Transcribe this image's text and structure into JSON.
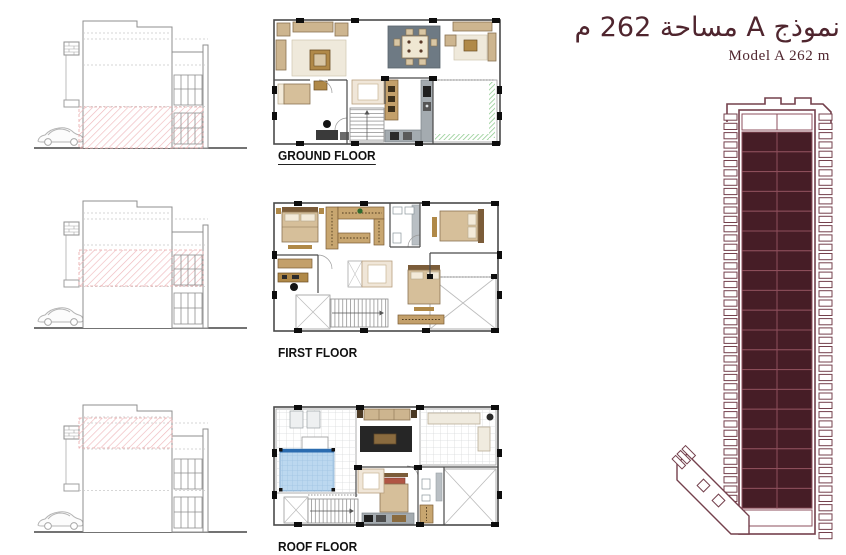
{
  "header": {
    "title_ar": "نموذج A مساحة 262 م",
    "title_en": "Model A 262 m"
  },
  "floors": [
    {
      "id": "ground",
      "label": "GROUND FLOOR"
    },
    {
      "id": "first",
      "label": "FIRST FLOOR"
    },
    {
      "id": "roof",
      "label": "ROOF FLOOR"
    }
  ],
  "site_plan": {
    "columns": 2,
    "unit_rows": 19,
    "top_white_rows": 1,
    "left_parking_slots": 43,
    "right_parking_slots": 46
  },
  "colors": {
    "title_maroon": "#4f252e",
    "plot_fill": "#461d26",
    "plot_line": "#8e4f5c",
    "plot_outline": "#74404c",
    "hatch_pink": "#efb9bc",
    "grass_green": "#8cc98c",
    "pool_blue": "#bcd8ef"
  }
}
